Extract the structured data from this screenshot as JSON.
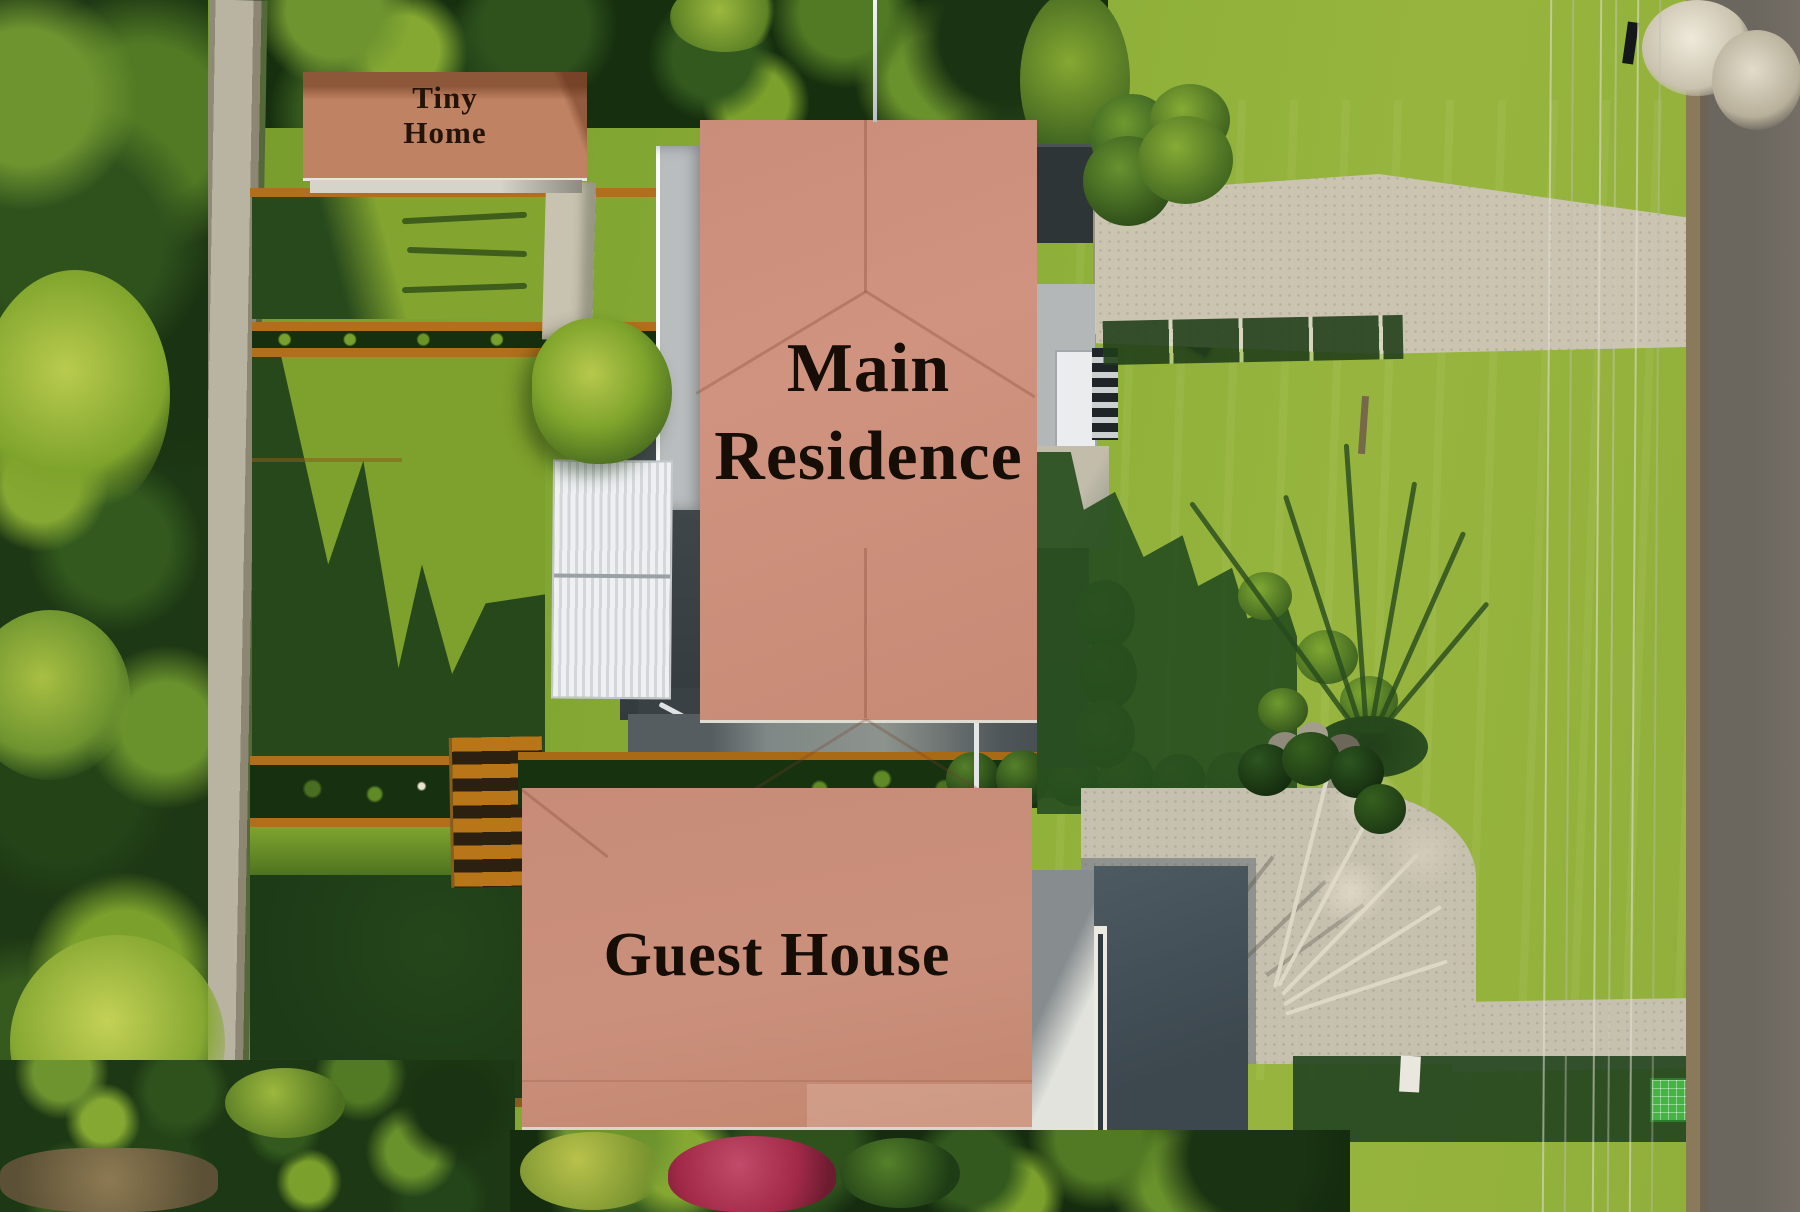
{
  "scene": {
    "kind": "aerial-property-photo"
  },
  "annotations": {
    "tiny_home": {
      "line1": "Tiny",
      "line2": "Home"
    },
    "main_residence": {
      "line1": "Main",
      "line2": "Residence"
    },
    "guest_house": {
      "label": "Guest House"
    }
  },
  "palette": {
    "overlay_salmon": "#cb8f7b",
    "overlay_salmon_tiny": "#bf8262",
    "label_text": "#150d06",
    "lawn_sunlit": "#8fae3a",
    "lawn_shadow": "#2a4e1f",
    "concrete": "#c9c2af",
    "asphalt": "#6b665e",
    "timber_orange": "#b06f1c",
    "deck_charcoal": "#3b4246",
    "pergola_white": "#e8eaec"
  }
}
